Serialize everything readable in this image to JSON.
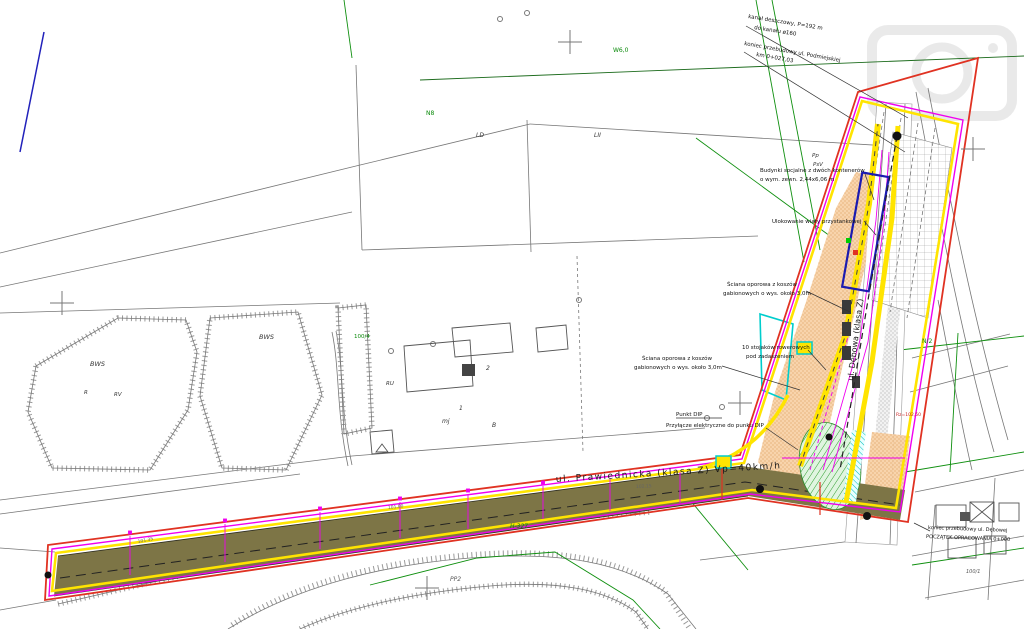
{
  "map_meta": {
    "type": "site-development-plan",
    "language": "pl"
  },
  "colors": {
    "road_surface": "#7d7546",
    "boundary_red": "#e03222",
    "boundary_magenta": "#f000f0",
    "curb_yellow": "#ffe400",
    "parcel_green": "#0f8f0f",
    "pavement_orange": "#f3c08f",
    "hatch_cyan": "#00cdcd",
    "building_navy": "#1b1bb0",
    "linework_gray": "#777777"
  },
  "streets": {
    "main_road": "ul. Prawiednicka (klasa Z) Vp=40km/h",
    "cross_road": "ul. Dębowa (klasa Z)"
  },
  "texts": [
    {
      "kind": "annotation",
      "t": "kanał deszczowy, P=192 m",
      "x": 748,
      "y": 18,
      "r": 9,
      "s": 5.5,
      "c": "#111"
    },
    {
      "kind": "annotation",
      "t": "do kanału ø160",
      "x": 754,
      "y": 29,
      "r": 9,
      "s": 5.5,
      "c": "#111"
    },
    {
      "kind": "annotation",
      "t": "koniec przebudowy ul. Podmiejskiej",
      "x": 744,
      "y": 45,
      "r": 10,
      "s": 5.5,
      "c": "#111"
    },
    {
      "kind": "annotation",
      "t": "km 0+027,03",
      "x": 756,
      "y": 56,
      "r": 10,
      "s": 5.5,
      "c": "#111"
    },
    {
      "kind": "annotation",
      "t": "Budynki socjalne z dwóch kontenerów",
      "x": 760,
      "y": 172,
      "s": 5.5,
      "c": "#111"
    },
    {
      "kind": "annotation",
      "t": "o wym. zewn. 2,44x6,06 m",
      "x": 760,
      "y": 181,
      "s": 5.5,
      "c": "#111"
    },
    {
      "kind": "annotation",
      "t": "Ulokowanie wiaty przystankowej",
      "x": 772,
      "y": 223,
      "s": 5.5,
      "c": "#111"
    },
    {
      "kind": "annotation",
      "t": "Ściana oporowa z koszów",
      "x": 727,
      "y": 286,
      "s": 5.5,
      "c": "#111"
    },
    {
      "kind": "annotation",
      "t": "gabionowych o wys. około 3,0m",
      "x": 723,
      "y": 295,
      "s": 5.5,
      "c": "#111"
    },
    {
      "kind": "annotation",
      "t": "10 stojaków rowerowych",
      "x": 742,
      "y": 349,
      "s": 5.5,
      "c": "#111"
    },
    {
      "kind": "annotation",
      "t": "pod zadaszeniem",
      "x": 746,
      "y": 358,
      "s": 5.5,
      "c": "#111"
    },
    {
      "kind": "annotation",
      "t": "Ściana oporowa z koszów",
      "x": 642,
      "y": 360,
      "s": 5.5,
      "c": "#111"
    },
    {
      "kind": "annotation",
      "t": "gabionowych o wys. około 3,0m",
      "x": 634,
      "y": 369,
      "s": 5.5,
      "c": "#111"
    },
    {
      "kind": "annotation",
      "t": "Punkt DIP",
      "x": 676,
      "y": 416,
      "s": 5.5,
      "c": "#111"
    },
    {
      "kind": "annotation",
      "t": "Przyłącze elektryczne do punku DIP",
      "x": 666,
      "y": 427,
      "s": 5.5,
      "c": "#111"
    },
    {
      "kind": "annotation",
      "t": "koniec przebudowy ul. Dębowej",
      "x": 928,
      "y": 529,
      "r": 2,
      "s": 5,
      "c": "#111"
    },
    {
      "kind": "annotation",
      "t": "POCZĄTEK OPRACOWANIA 0+000",
      "x": 926,
      "y": 538,
      "r": 2,
      "s": 5,
      "c": "#111"
    },
    {
      "kind": "street",
      "t": "ul. Prawiednicka (klasa Z) Vp=40km/h",
      "x": 556,
      "y": 482,
      "r": -3.5,
      "s": 9,
      "c": "#1a1a1a",
      "ls": 1.5
    },
    {
      "kind": "street",
      "t": "ul. Dębowa (klasa Z)",
      "x": 858,
      "y": 340,
      "r": -83,
      "s": 8,
      "c": "#1a1a1a",
      "a": "middle"
    },
    {
      "kind": "parcel",
      "t": "W6,0",
      "x": 613,
      "y": 52,
      "s": 6,
      "c": "#0a8a0a"
    },
    {
      "kind": "parcel",
      "t": "N8",
      "x": 426,
      "y": 115,
      "s": 6,
      "c": "#0a8a0a"
    },
    {
      "kind": "parcel",
      "t": "100/4",
      "x": 354,
      "y": 338,
      "s": 5.5,
      "c": "#0a8a0a"
    },
    {
      "kind": "parcel",
      "t": "H-327",
      "x": 510,
      "y": 528,
      "s": 6,
      "c": "#0a8a0a",
      "i": true
    },
    {
      "kind": "parcel",
      "t": "N/2",
      "x": 922,
      "y": 343,
      "s": 6,
      "c": "#0a8a0a"
    },
    {
      "kind": "parcel",
      "t": "LII",
      "x": 594,
      "y": 137,
      "s": 6,
      "c": "#333",
      "i": true
    },
    {
      "kind": "parcel",
      "t": "LD",
      "x": 476,
      "y": 137,
      "s": 6,
      "c": "#333",
      "i": true
    },
    {
      "kind": "parcel",
      "t": "BWS",
      "x": 90,
      "y": 366,
      "s": 6.5,
      "c": "#333",
      "i": true
    },
    {
      "kind": "parcel",
      "t": "BWS",
      "x": 259,
      "y": 339,
      "s": 6.5,
      "c": "#333",
      "i": true
    },
    {
      "kind": "parcel",
      "t": "R",
      "x": 84,
      "y": 394,
      "s": 5.5,
      "c": "#333",
      "i": true
    },
    {
      "kind": "parcel",
      "t": "RV",
      "x": 114,
      "y": 396,
      "s": 5.5,
      "c": "#333",
      "i": true
    },
    {
      "kind": "parcel",
      "t": "Pp",
      "x": 812,
      "y": 157,
      "s": 5.5,
      "c": "#333",
      "i": true
    },
    {
      "kind": "parcel",
      "t": "PsV",
      "x": 813,
      "y": 166,
      "s": 5.5,
      "c": "#333",
      "i": true
    },
    {
      "kind": "parcel",
      "t": "mj",
      "x": 442,
      "y": 423,
      "s": 6,
      "c": "#333",
      "i": true
    },
    {
      "kind": "parcel",
      "t": "2",
      "x": 486,
      "y": 370,
      "s": 6,
      "c": "#333",
      "i": true
    },
    {
      "kind": "parcel",
      "t": "1",
      "x": 459,
      "y": 410,
      "s": 6,
      "c": "#333",
      "i": true
    },
    {
      "kind": "parcel",
      "t": "B",
      "x": 492,
      "y": 427,
      "s": 6,
      "c": "#333",
      "i": true
    },
    {
      "kind": "parcel",
      "t": "RU",
      "x": 386,
      "y": 385,
      "s": 5.5,
      "c": "#333",
      "i": true
    },
    {
      "kind": "parcel",
      "t": "PP2",
      "x": 450,
      "y": 581,
      "s": 6,
      "c": "#555",
      "i": true
    },
    {
      "kind": "parcel",
      "t": "100/1",
      "x": 966,
      "y": 573,
      "s": 5,
      "c": "#555",
      "i": true
    },
    {
      "kind": "elevation",
      "t": "101.35",
      "x": 138,
      "y": 543,
      "r": -11,
      "s": 4.5,
      "c": "#666"
    },
    {
      "kind": "elevation",
      "t": "101.80",
      "x": 388,
      "y": 509,
      "r": -6,
      "s": 4.5,
      "c": "#666"
    },
    {
      "kind": "elevation",
      "t": "102.15",
      "x": 636,
      "y": 488,
      "r": -3,
      "s": 4.5,
      "c": "#666"
    },
    {
      "kind": "elevation",
      "t": "Rz=102,50",
      "x": 896,
      "y": 416,
      "s": 4.5,
      "c": "#cc2222"
    }
  ]
}
